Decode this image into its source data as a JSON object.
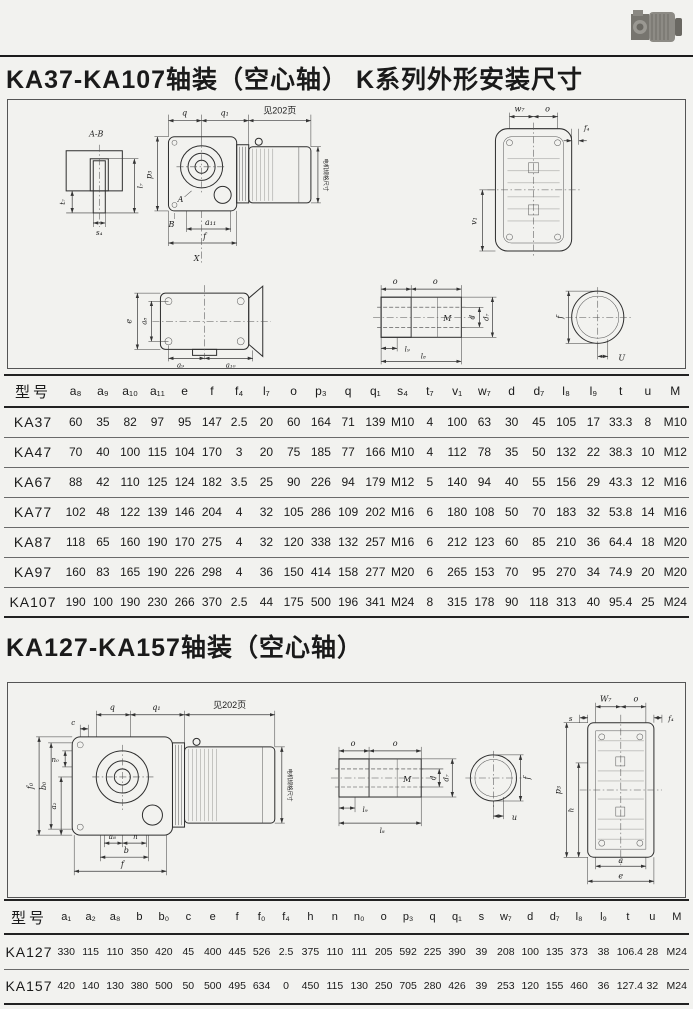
{
  "header": {
    "title1": "KA37-KA107轴装（空心轴）  K系列外形安装尺寸",
    "title2": "KA127-KA157轴装（空心轴）"
  },
  "d1": {
    "AB": "A-B",
    "t7": "t₇",
    "l7": "l₇",
    "s4": "s₄",
    "q": "q",
    "q1": "q₁",
    "see": "见202页",
    "p3": "p₃",
    "A": "A",
    "B": "B",
    "a11": "a₁₁",
    "f": "f",
    "X": "X",
    "motor_note": "电机规格尺寸",
    "w7": "w₇",
    "o_top": "o",
    "f4": "f₄",
    "v1": "v₁",
    "e": "e",
    "a8": "a₈",
    "a9": "a₉",
    "a10": "a₁₀",
    "o": "o",
    "o2": "o",
    "M": "M",
    "d": "d",
    "d7": "d₇",
    "l9": "l₉",
    "l8": "l₈",
    "fc": "f",
    "U": "U"
  },
  "d2": {
    "q": "q",
    "q1": "q₁",
    "see": "见202页",
    "c": "c",
    "n0": "n₀",
    "f0": "f₀",
    "b0": "b₀",
    "a2": "a₂",
    "a8": "a₈",
    "n": "n",
    "b": "b",
    "f": "f",
    "motor_note": "电机规格尺寸",
    "o": "o",
    "o2": "o",
    "M": "M",
    "d": "d",
    "d7": "d₇",
    "l9": "l₉",
    "l8": "l₈",
    "fc": "f",
    "u": "u",
    "W7": "W₇",
    "o3": "o",
    "s": "s",
    "f4": "f₄",
    "p3": "p₃",
    "h": "h",
    "a": "a",
    "e": "e"
  },
  "table1": {
    "headers": [
      "型号",
      "a₈",
      "a₉",
      "a₁₀",
      "a₁₁",
      "e",
      "f",
      "f₄",
      "l₇",
      "o",
      "p₃",
      "q",
      "q₁",
      "s₄",
      "t₇",
      "v₁",
      "w₇",
      "d",
      "d₇",
      "l₈",
      "l₉",
      "t",
      "u",
      "M"
    ],
    "rows": [
      [
        "KA37",
        "60",
        "35",
        "82",
        "97",
        "95",
        "147",
        "2.5",
        "20",
        "60",
        "164",
        "71",
        "139",
        "M10",
        "4",
        "100",
        "63",
        "30",
        "45",
        "105",
        "17",
        "33.3",
        "8",
        "M10"
      ],
      [
        "KA47",
        "70",
        "40",
        "100",
        "115",
        "104",
        "170",
        "3",
        "20",
        "75",
        "185",
        "77",
        "166",
        "M10",
        "4",
        "112",
        "78",
        "35",
        "50",
        "132",
        "22",
        "38.3",
        "10",
        "M12"
      ],
      [
        "KA67",
        "88",
        "42",
        "110",
        "125",
        "124",
        "182",
        "3.5",
        "25",
        "90",
        "226",
        "94",
        "179",
        "M12",
        "5",
        "140",
        "94",
        "40",
        "55",
        "156",
        "29",
        "43.3",
        "12",
        "M16"
      ],
      [
        "KA77",
        "102",
        "48",
        "122",
        "139",
        "146",
        "204",
        "4",
        "32",
        "105",
        "286",
        "109",
        "202",
        "M16",
        "6",
        "180",
        "108",
        "50",
        "70",
        "183",
        "32",
        "53.8",
        "14",
        "M16"
      ],
      [
        "KA87",
        "118",
        "65",
        "160",
        "190",
        "170",
        "275",
        "4",
        "32",
        "120",
        "338",
        "132",
        "257",
        "M16",
        "6",
        "212",
        "123",
        "60",
        "85",
        "210",
        "36",
        "64.4",
        "18",
        "M20"
      ],
      [
        "KA97",
        "160",
        "83",
        "165",
        "190",
        "226",
        "298",
        "4",
        "36",
        "150",
        "414",
        "158",
        "277",
        "M20",
        "6",
        "265",
        "153",
        "70",
        "95",
        "270",
        "34",
        "74.9",
        "20",
        "M20"
      ],
      [
        "KA107",
        "190",
        "100",
        "190",
        "230",
        "266",
        "370",
        "2.5",
        "44",
        "175",
        "500",
        "196",
        "341",
        "M24",
        "8",
        "315",
        "178",
        "90",
        "118",
        "313",
        "40",
        "95.4",
        "25",
        "M24"
      ]
    ]
  },
  "table2": {
    "headers": [
      "型号",
      "a₁",
      "a₂",
      "a₈",
      "b",
      "b₀",
      "c",
      "e",
      "f",
      "f₀",
      "f₄",
      "h",
      "n",
      "n₀",
      "o",
      "p₃",
      "q",
      "q₁",
      "s",
      "w₇",
      "d",
      "d₇",
      "l₈",
      "l₉",
      "t",
      "u",
      "M"
    ],
    "rows": [
      [
        "KA127",
        "330",
        "115",
        "110",
        "350",
        "420",
        "45",
        "400",
        "445",
        "526",
        "2.5",
        "375",
        "110",
        "111",
        "205",
        "592",
        "225",
        "390",
        "39",
        "208",
        "100",
        "135",
        "373",
        "38",
        "106.4",
        "28",
        "M24"
      ],
      [
        "KA157",
        "420",
        "140",
        "130",
        "380",
        "500",
        "50",
        "500",
        "495",
        "634",
        "0",
        "450",
        "115",
        "130",
        "250",
        "705",
        "280",
        "426",
        "39",
        "253",
        "120",
        "155",
        "460",
        "36",
        "127.4",
        "32",
        "M24"
      ]
    ]
  }
}
